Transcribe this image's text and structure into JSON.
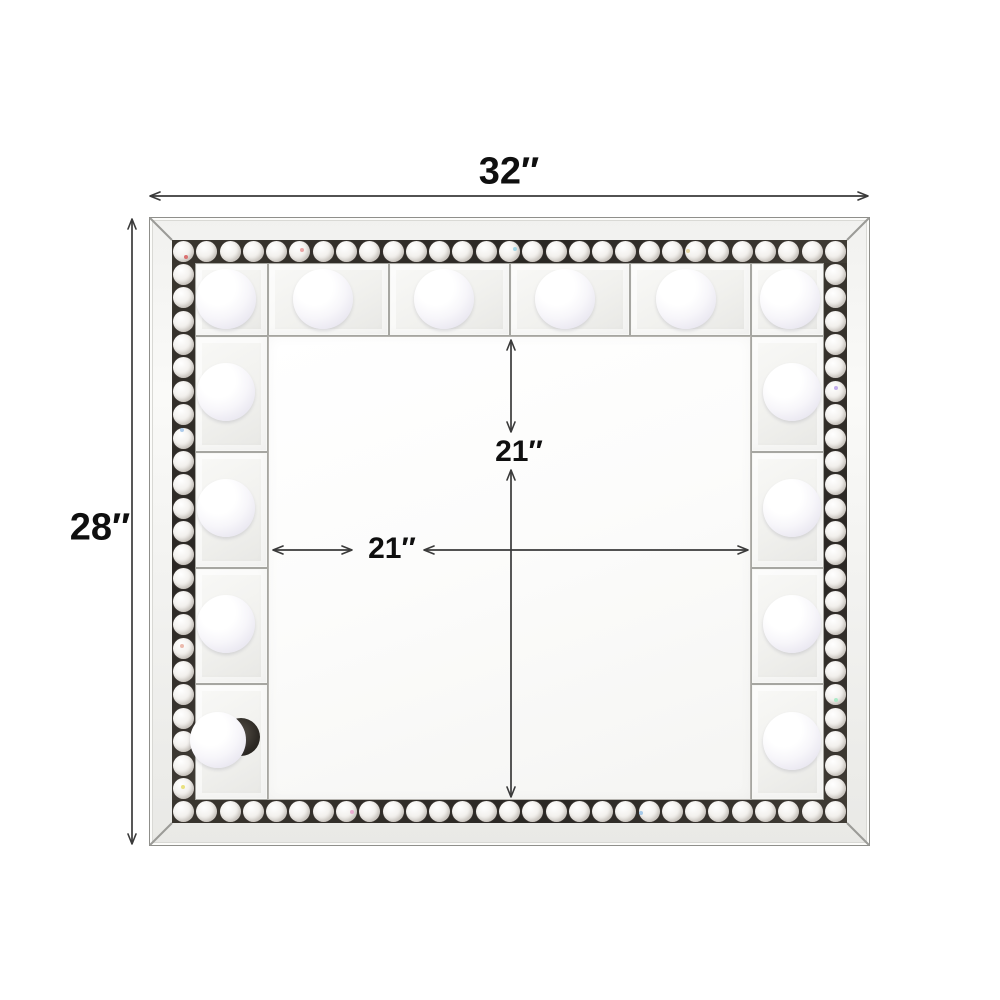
{
  "labels": {
    "overall_width": "32″",
    "overall_height": "28″",
    "inner_width": "21″",
    "inner_height": "21″"
  },
  "colors": {
    "background": "#ffffff",
    "dimension_line": "#3a3a3a",
    "label_text": "#0f0f0f",
    "frame_face": "#f3f3f1",
    "band_background": "#2e2a26",
    "crystal_face": "#f0eeeb",
    "panel_face": "#f1f1ee",
    "glass_face": "#fcfcfb",
    "bulb_face": "#ffffff",
    "bulb_rim": "#d9d7e3"
  },
  "structure": {
    "outer": {
      "x": 149,
      "y": 217,
      "w": 721,
      "h": 629
    },
    "frame_thickness": 23,
    "band_thickness": 23,
    "panel_depth": 73,
    "top_panel_count": 4,
    "side_row_count": 4,
    "crystal_counts": {
      "top": 29,
      "bottom": 29,
      "left": 23,
      "right": 23
    },
    "bulbs": [
      {
        "cx": 226,
        "cy": 299,
        "r": 30
      },
      {
        "cx": 323,
        "cy": 299,
        "r": 30
      },
      {
        "cx": 444,
        "cy": 299,
        "r": 30
      },
      {
        "cx": 565,
        "cy": 299,
        "r": 30
      },
      {
        "cx": 686,
        "cy": 299,
        "r": 30
      },
      {
        "cx": 790,
        "cy": 299,
        "r": 30
      },
      {
        "cx": 226,
        "cy": 392,
        "r": 29
      },
      {
        "cx": 226,
        "cy": 508,
        "r": 29
      },
      {
        "cx": 226,
        "cy": 624,
        "r": 29
      },
      {
        "cx": 218,
        "cy": 740,
        "r": 28,
        "socket": {
          "cx": 241,
          "cy": 737,
          "r": 19
        }
      },
      {
        "cx": 792,
        "cy": 392,
        "r": 29
      },
      {
        "cx": 792,
        "cy": 508,
        "r": 29
      },
      {
        "cx": 792,
        "cy": 624,
        "r": 29
      },
      {
        "cx": 792,
        "cy": 741,
        "r": 29
      }
    ],
    "sparkles": [
      {
        "x": 302,
        "y": 250,
        "color": "#e8a0a0"
      },
      {
        "x": 515,
        "y": 249,
        "color": "#9fd4e4"
      },
      {
        "x": 688,
        "y": 251,
        "color": "#e4d49f"
      },
      {
        "x": 186,
        "y": 257,
        "color": "#d96a6a"
      },
      {
        "x": 182,
        "y": 430,
        "color": "#a9c8ea"
      },
      {
        "x": 182,
        "y": 646,
        "color": "#eab6a9"
      },
      {
        "x": 183,
        "y": 787,
        "color": "#e8df7a"
      },
      {
        "x": 836,
        "y": 388,
        "color": "#bfa9ea"
      },
      {
        "x": 836,
        "y": 700,
        "color": "#a9eac6"
      },
      {
        "x": 352,
        "y": 812,
        "color": "#eaa9d0"
      },
      {
        "x": 641,
        "y": 813,
        "color": "#a0c6e8"
      }
    ]
  }
}
